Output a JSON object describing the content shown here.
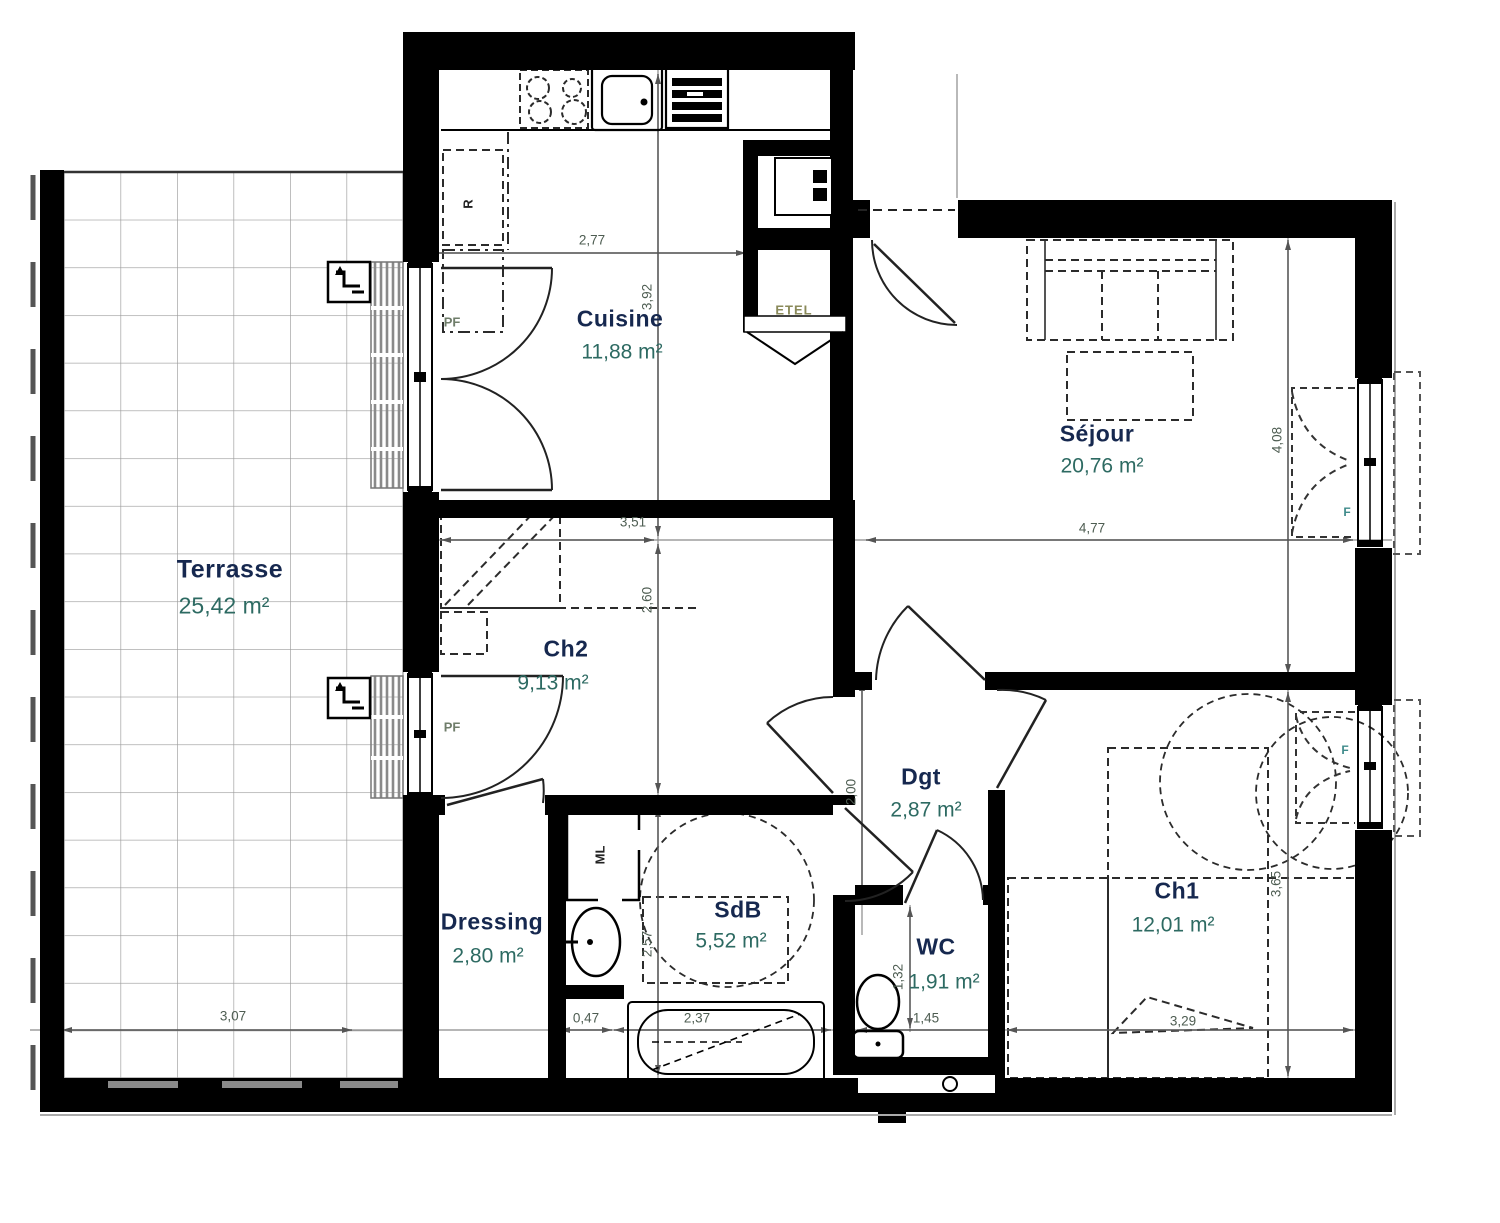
{
  "floorplan": {
    "rooms": [
      {
        "id": "terrasse",
        "name": "Terrasse",
        "area": "25,42 m²"
      },
      {
        "id": "cuisine",
        "name": "Cuisine",
        "area": "11,88 m²"
      },
      {
        "id": "sejour",
        "name": "Séjour",
        "area": "20,76 m²"
      },
      {
        "id": "ch2",
        "name": "Ch2",
        "area": "9,13 m²"
      },
      {
        "id": "dgt",
        "name": "Dgt",
        "area": "2,87 m²"
      },
      {
        "id": "dressing",
        "name": "Dressing",
        "area": "2,80 m²"
      },
      {
        "id": "sdb",
        "name": "SdB",
        "area": "5,52 m²"
      },
      {
        "id": "wc",
        "name": "WC",
        "area": "1,91 m²"
      },
      {
        "id": "ch1",
        "name": "Ch1",
        "area": "12,01 m²"
      }
    ],
    "dimensions": {
      "cuisine_w": "2,77",
      "cuisine_h": "3,92",
      "ch2_w": "3,51",
      "ch2_h": "2,60",
      "sejour_w": "4,77",
      "sejour_h": "4,08",
      "dgt_h": "2,00",
      "sdb_h": "2,57",
      "terrasse_w": "3,07",
      "basin_nook_w": "0,47",
      "bath_w": "2,37",
      "wc_h": "1,32",
      "wc_w": "1,45",
      "ch1_w": "3,29",
      "ch1_h": "3,65"
    },
    "fixture_labels": {
      "fridge": "R",
      "washing_machine": "ML",
      "tech_closet": "ETEL"
    },
    "window_labels": {
      "french_door": "PF",
      "window": "F"
    },
    "colors": {
      "room_name": "#16284f",
      "room_area": "#2d6a62",
      "dimension": "#4e5d52",
      "wall": "#000000",
      "label_accent": "#6f7d6a",
      "window_label": "#3f8b8b",
      "tech_label": "#8a8a5a"
    }
  }
}
